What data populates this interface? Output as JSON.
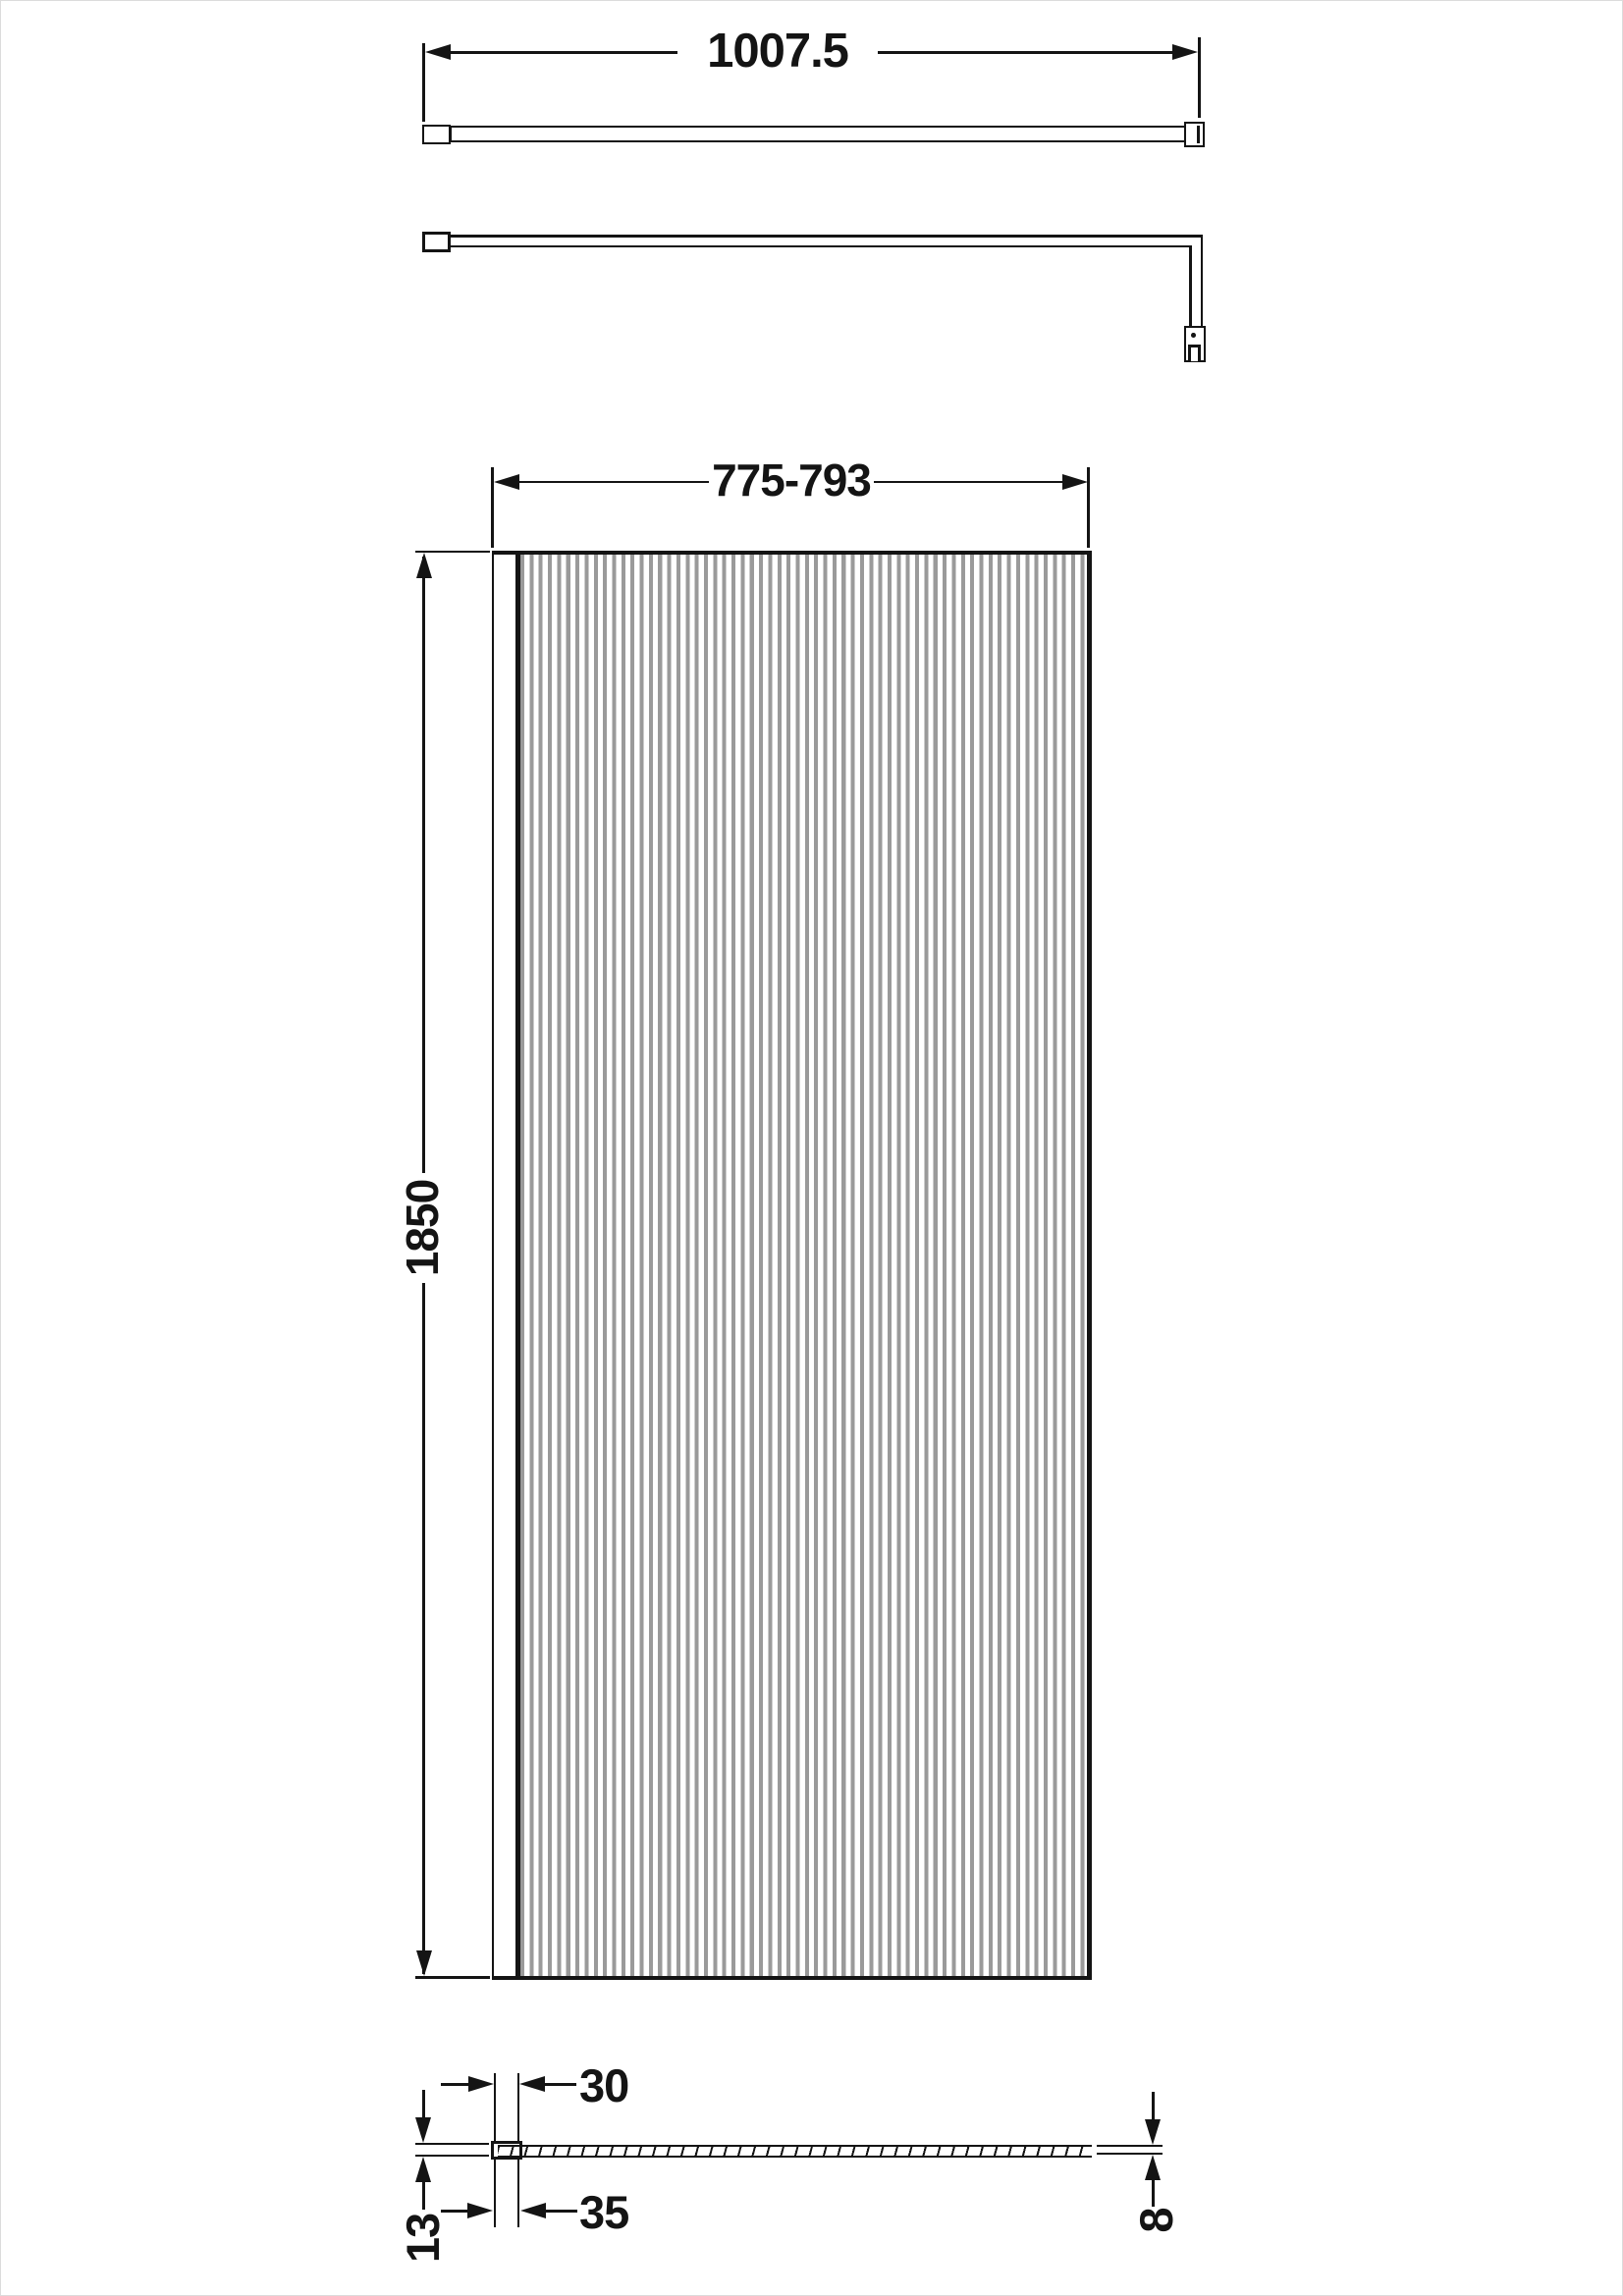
{
  "document": {
    "type": "technical-drawing",
    "subject": "fluted glass wetroom shower screen with wall profile and support bar"
  },
  "colors": {
    "ink": "#141414",
    "flute": "#9a9a9a",
    "paper": "#ffffff",
    "frame": "#dcdcdc"
  },
  "dimensions": {
    "support_bar_length": "1007.5",
    "panel_width_range": "775-793",
    "panel_height": "1850",
    "profile_inner_width": "30",
    "profile_outer_width": "35",
    "profile_depth": "13",
    "glass_thickness": "8"
  }
}
